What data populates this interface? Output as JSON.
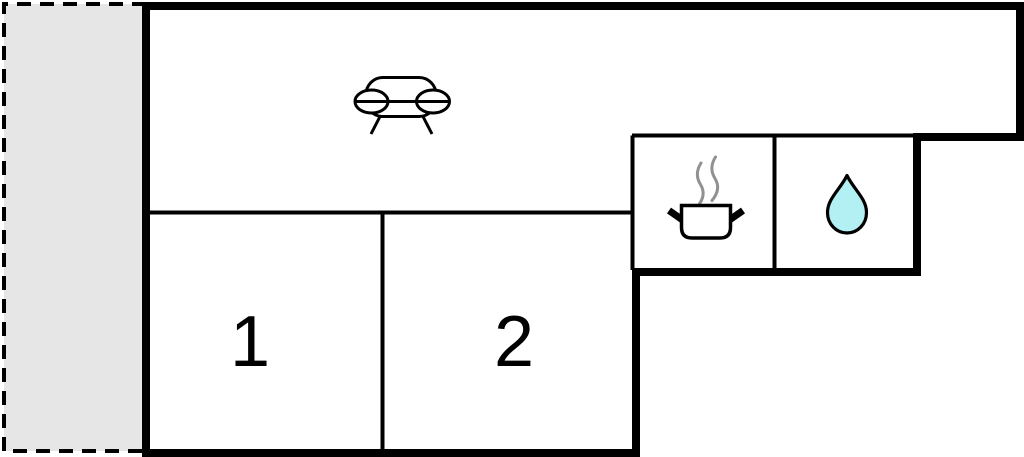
{
  "floorplan": {
    "room_labels": {
      "room1": "1",
      "room2": "2"
    },
    "icons": {
      "living_room": "sofa-icon",
      "kitchen": "cooking-pot-icon",
      "bathroom": "water-drop-icon"
    },
    "colors": {
      "wall": "#000000",
      "background": "#ffffff",
      "terrace_fill": "#e6e6e6",
      "steam": "#919191",
      "water_drop_fill": "#b3f0f4"
    }
  }
}
